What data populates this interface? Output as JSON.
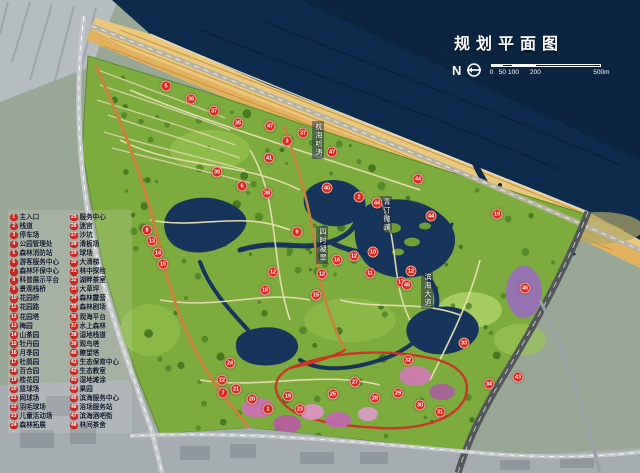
{
  "title": {
    "text": "规划平面图"
  },
  "compass": {
    "label": "N",
    "icon": "north-circle-arrow"
  },
  "scalebar": {
    "ticks": [
      "0",
      "50",
      "100",
      "200"
    ],
    "end": "500m"
  },
  "colors": {
    "accent_red": "#d5281e",
    "sea": "#0d2b4c",
    "beach": "#dfae58",
    "park_green": "#7cab3e",
    "water": "#16355c",
    "main_path_orange": "#c8833c",
    "loop_road_red": "#cd3527",
    "flower_pink": "#cf6fb8",
    "urban_gray": "#a6adb0"
  },
  "legend": {
    "columns": [
      {
        "items": [
          {
            "num": "1",
            "label": "主入口"
          },
          {
            "num": "2",
            "label": "栈道"
          },
          {
            "num": "3",
            "label": "停车场"
          },
          {
            "num": "4",
            "label": "公园管理处"
          },
          {
            "num": "5",
            "label": "森林消防站"
          },
          {
            "num": "6",
            "label": "游客服务中心"
          },
          {
            "num": "7",
            "label": "森林环保中心"
          },
          {
            "num": "8",
            "label": "科普展示平台"
          },
          {
            "num": "9",
            "label": "景观栈桥"
          },
          {
            "num": "10",
            "label": "花园桥"
          },
          {
            "num": "11",
            "label": "花园路"
          },
          {
            "num": "12",
            "label": "花园塔"
          },
          {
            "num": "13",
            "label": "梅园"
          },
          {
            "num": "14",
            "label": "山茶园"
          },
          {
            "num": "15",
            "label": "牡丹园"
          },
          {
            "num": "16",
            "label": "月季园"
          },
          {
            "num": "17",
            "label": "杜鹃园"
          },
          {
            "num": "18",
            "label": "百合园"
          },
          {
            "num": "19",
            "label": "桂花园"
          },
          {
            "num": "20",
            "label": "篮球场"
          },
          {
            "num": "21",
            "label": "网球场"
          },
          {
            "num": "22",
            "label": "羽毛球场"
          },
          {
            "num": "23",
            "label": "儿童活动场"
          },
          {
            "num": "24",
            "label": "森林拓展"
          }
        ]
      },
      {
        "items": [
          {
            "num": "25",
            "label": "服务中心"
          },
          {
            "num": "26",
            "label": "迷宫"
          },
          {
            "num": "27",
            "label": "沙坑"
          },
          {
            "num": "28",
            "label": "滑板场"
          },
          {
            "num": "29",
            "label": "球场"
          },
          {
            "num": "30",
            "label": "大滑梯"
          },
          {
            "num": "31",
            "label": "林中探险"
          },
          {
            "num": "32",
            "label": "湖畔茶室"
          },
          {
            "num": "33",
            "label": "大草坪"
          },
          {
            "num": "34",
            "label": "森林露营"
          },
          {
            "num": "35",
            "label": "森林剧场"
          },
          {
            "num": "36",
            "label": "观海平台"
          },
          {
            "num": "37",
            "label": "水上森林"
          },
          {
            "num": "38",
            "label": "湿地栈道"
          },
          {
            "num": "39",
            "label": "观鸟塔"
          },
          {
            "num": "40",
            "label": "瞭望塔"
          },
          {
            "num": "41",
            "label": "生态保育中心"
          },
          {
            "num": "42",
            "label": "生态教室"
          },
          {
            "num": "43",
            "label": "湿地滩涂"
          },
          {
            "num": "44",
            "label": "果园"
          },
          {
            "num": "45",
            "label": "滨海服务中心"
          },
          {
            "num": "46",
            "label": "浴场服务站"
          },
          {
            "num": "47",
            "label": "滨海酒吧街"
          },
          {
            "num": "48",
            "label": "林间茶舍"
          }
        ]
      }
    ]
  },
  "map_labels": [
    {
      "text": "枕海听涛",
      "x": 312,
      "y": 121
    },
    {
      "text": "青汀微澜",
      "x": 380,
      "y": 196
    },
    {
      "text": "四时凝翠",
      "x": 316,
      "y": 226
    },
    {
      "text": "滨海大道",
      "x": 421,
      "y": 271
    }
  ],
  "markers": [
    {
      "n": "47",
      "x": 270,
      "y": 126
    },
    {
      "n": "37",
      "x": 303,
      "y": 133
    },
    {
      "n": "3",
      "x": 287,
      "y": 141
    },
    {
      "n": "47",
      "x": 332,
      "y": 152
    },
    {
      "n": "41",
      "x": 269,
      "y": 158
    },
    {
      "n": "38",
      "x": 267,
      "y": 193
    },
    {
      "n": "40",
      "x": 327,
      "y": 188
    },
    {
      "n": "2",
      "x": 359,
      "y": 197
    },
    {
      "n": "44",
      "x": 377,
      "y": 203
    },
    {
      "n": "44",
      "x": 418,
      "y": 179
    },
    {
      "n": "44",
      "x": 431,
      "y": 216
    },
    {
      "n": "9",
      "x": 297,
      "y": 232
    },
    {
      "n": "10",
      "x": 373,
      "y": 252
    },
    {
      "n": "12",
      "x": 354,
      "y": 256
    },
    {
      "n": "16",
      "x": 337,
      "y": 260
    },
    {
      "n": "12",
      "x": 273,
      "y": 272
    },
    {
      "n": "12",
      "x": 322,
      "y": 274
    },
    {
      "n": "11",
      "x": 370,
      "y": 273
    },
    {
      "n": "12",
      "x": 411,
      "y": 271
    },
    {
      "n": "17",
      "x": 401,
      "y": 282
    },
    {
      "n": "15",
      "x": 316,
      "y": 295
    },
    {
      "n": "18",
      "x": 265,
      "y": 290
    },
    {
      "n": "45",
      "x": 407,
      "y": 285
    },
    {
      "n": "5",
      "x": 166,
      "y": 86
    },
    {
      "n": "36",
      "x": 191,
      "y": 99
    },
    {
      "n": "37",
      "x": 214,
      "y": 111
    },
    {
      "n": "35",
      "x": 238,
      "y": 123
    },
    {
      "n": "39",
      "x": 217,
      "y": 172
    },
    {
      "n": "6",
      "x": 242,
      "y": 186
    },
    {
      "n": "8",
      "x": 147,
      "y": 230
    },
    {
      "n": "13",
      "x": 152,
      "y": 241
    },
    {
      "n": "14",
      "x": 158,
      "y": 253
    },
    {
      "n": "15",
      "x": 163,
      "y": 264
    },
    {
      "n": "24",
      "x": 230,
      "y": 363
    },
    {
      "n": "7",
      "x": 223,
      "y": 393
    },
    {
      "n": "22",
      "x": 222,
      "y": 380
    },
    {
      "n": "21",
      "x": 236,
      "y": 389
    },
    {
      "n": "20",
      "x": 252,
      "y": 399
    },
    {
      "n": "1",
      "x": 268,
      "y": 409
    },
    {
      "n": "19",
      "x": 288,
      "y": 396
    },
    {
      "n": "23",
      "x": 300,
      "y": 409
    },
    {
      "n": "25",
      "x": 333,
      "y": 394
    },
    {
      "n": "27",
      "x": 355,
      "y": 382
    },
    {
      "n": "28",
      "x": 375,
      "y": 398
    },
    {
      "n": "29",
      "x": 398,
      "y": 393
    },
    {
      "n": "30",
      "x": 420,
      "y": 405
    },
    {
      "n": "31",
      "x": 440,
      "y": 412
    },
    {
      "n": "32",
      "x": 408,
      "y": 360
    },
    {
      "n": "33",
      "x": 464,
      "y": 343
    },
    {
      "n": "34",
      "x": 489,
      "y": 384
    },
    {
      "n": "43",
      "x": 518,
      "y": 377
    },
    {
      "n": "19",
      "x": 497,
      "y": 214
    },
    {
      "n": "46",
      "x": 525,
      "y": 288
    }
  ]
}
